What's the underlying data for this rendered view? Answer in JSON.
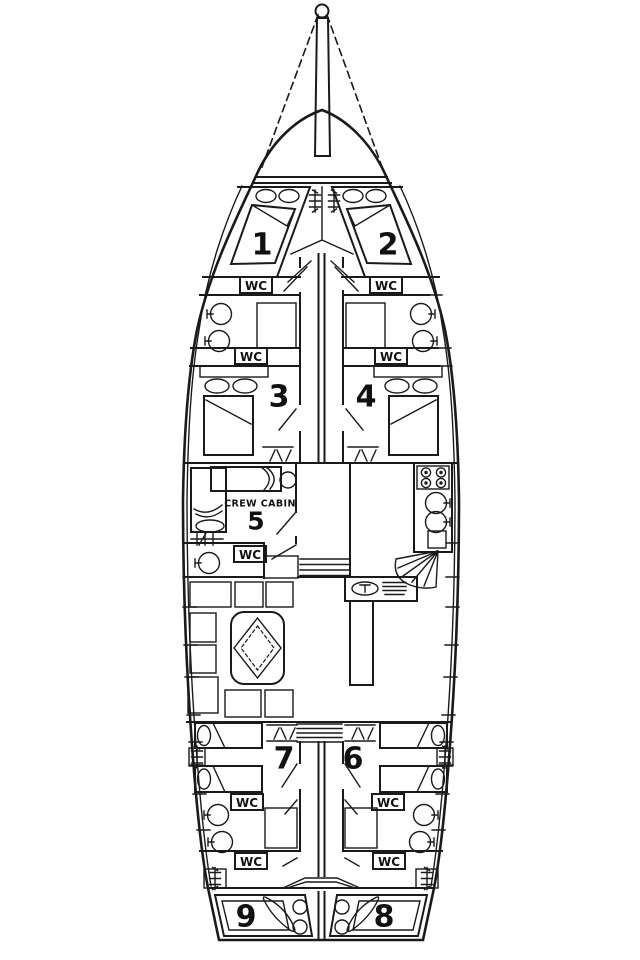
{
  "plan": {
    "type": "sailing-yacht-deck-plan",
    "vessel": "gulet / sailing yacht interior layout",
    "orientation": "bow-up",
    "line_color": "#1a1a1a",
    "background_color": "#ffffff"
  },
  "labels": {
    "wc": "WC",
    "crew_cabin": "CREW CABIN"
  },
  "cabins": [
    {
      "number": "1",
      "location": "bow port double cabin"
    },
    {
      "number": "2",
      "location": "bow starboard double cabin"
    },
    {
      "number": "3",
      "location": "forward port double cabin"
    },
    {
      "number": "4",
      "location": "forward starboard double cabin"
    },
    {
      "number": "5",
      "location": "midship port crew cabin"
    },
    {
      "number": "6",
      "location": "aft starboard twin cabin"
    },
    {
      "number": "7",
      "location": "aft port twin cabin"
    },
    {
      "number": "8",
      "location": "stern starboard double cabin"
    },
    {
      "number": "9",
      "location": "stern port double cabin"
    }
  ],
  "wc_count": 9,
  "fixtures": [
    "mast-icon",
    "rigging-lines",
    "windlass-ladder-icon",
    "double-bed",
    "single-bed",
    "pillow",
    "wash-basin-icon",
    "shower-grid-icon",
    "stove-icon",
    "galley-sink-icon",
    "fan-stairs-icon",
    "companionway-stairs-icon",
    "salon-table",
    "settee-seats",
    "bar-counter",
    "boarding-ladder-icon"
  ]
}
